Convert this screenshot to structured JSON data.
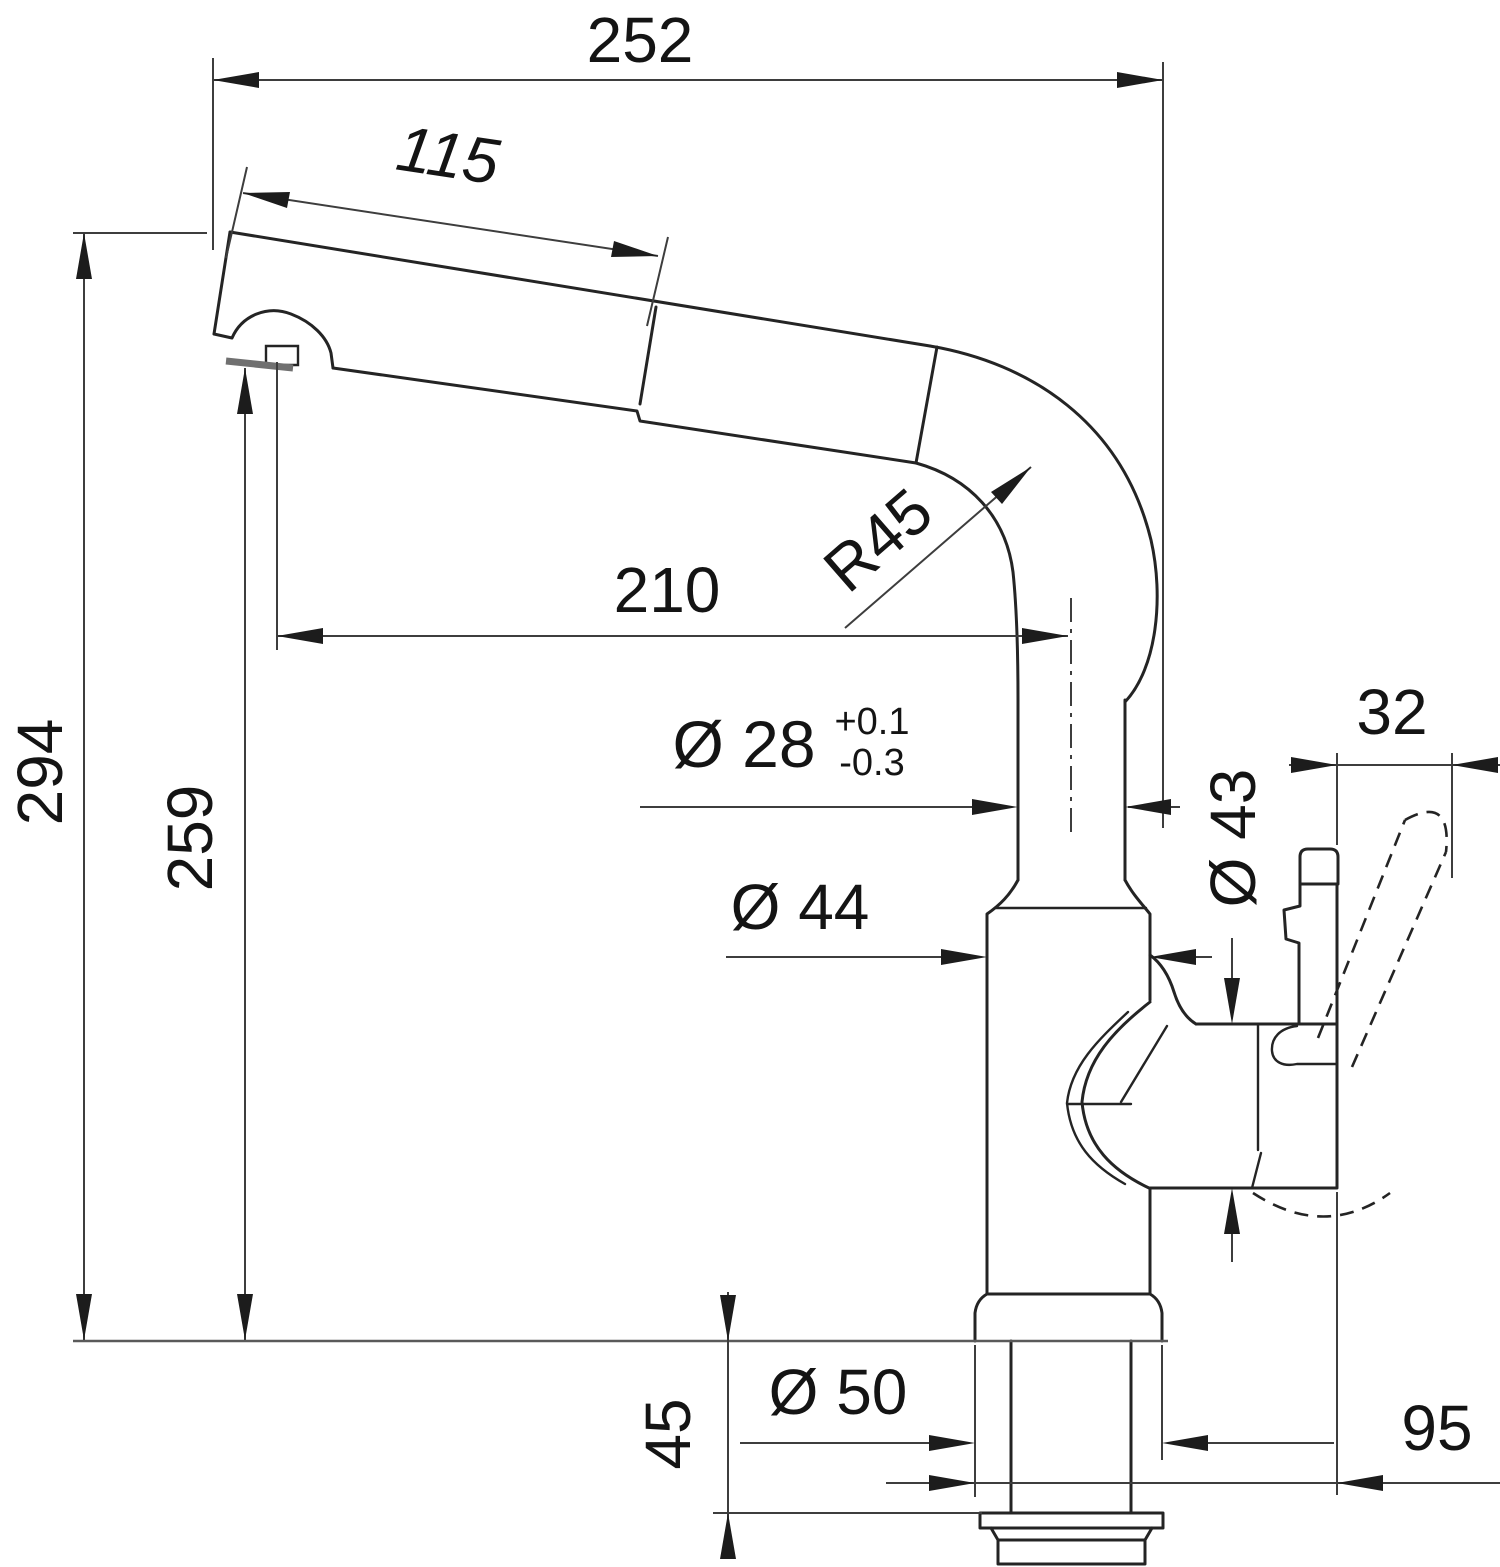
{
  "colors": {
    "background": "#ffffff",
    "outline": "#242424",
    "dimension_lines": "#3d3d3d",
    "label_text": "#141414",
    "deck_line": "#5a5a5a",
    "outlet_face": "#707070"
  },
  "dims": {
    "overall_width": "252",
    "spray_head_length": "115",
    "total_height": "294",
    "outlet_height": "259",
    "reach": "210",
    "bend_radius": "R45",
    "riser_diameter": "Ø 28",
    "riser_tol_plus": "+0.1",
    "riser_tol_minus": "-0.3",
    "body_diameter": "Ø 44",
    "cartridge_diameter": "Ø 43",
    "lever_tip_width": "32",
    "lever_reach": "95",
    "base_diameter": "Ø 50",
    "shank_length": "45"
  }
}
